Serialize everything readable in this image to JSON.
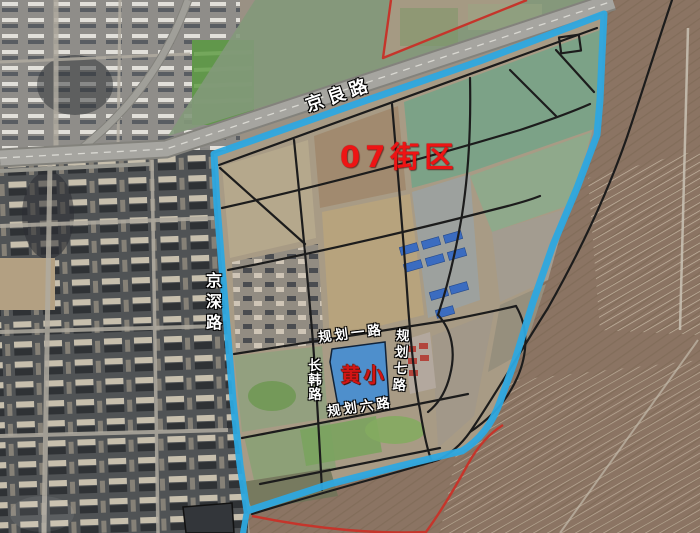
{
  "map": {
    "block_label": "07街区",
    "school": {
      "name": "黄小"
    },
    "roads": {
      "jingliang": "京良路",
      "jingshen": "京深路",
      "changhan": "长韩路",
      "guihua_yi": "规划一路",
      "guihua_qi": "规划七路",
      "guihua_liu": "规划六路"
    },
    "colors": {
      "boundary_blue": "#2da8e0",
      "school_fill": "#4e8fcc",
      "red_label": "#ee1414",
      "red_line": "#c5352b",
      "road_black": "#1c1c1c"
    }
  }
}
